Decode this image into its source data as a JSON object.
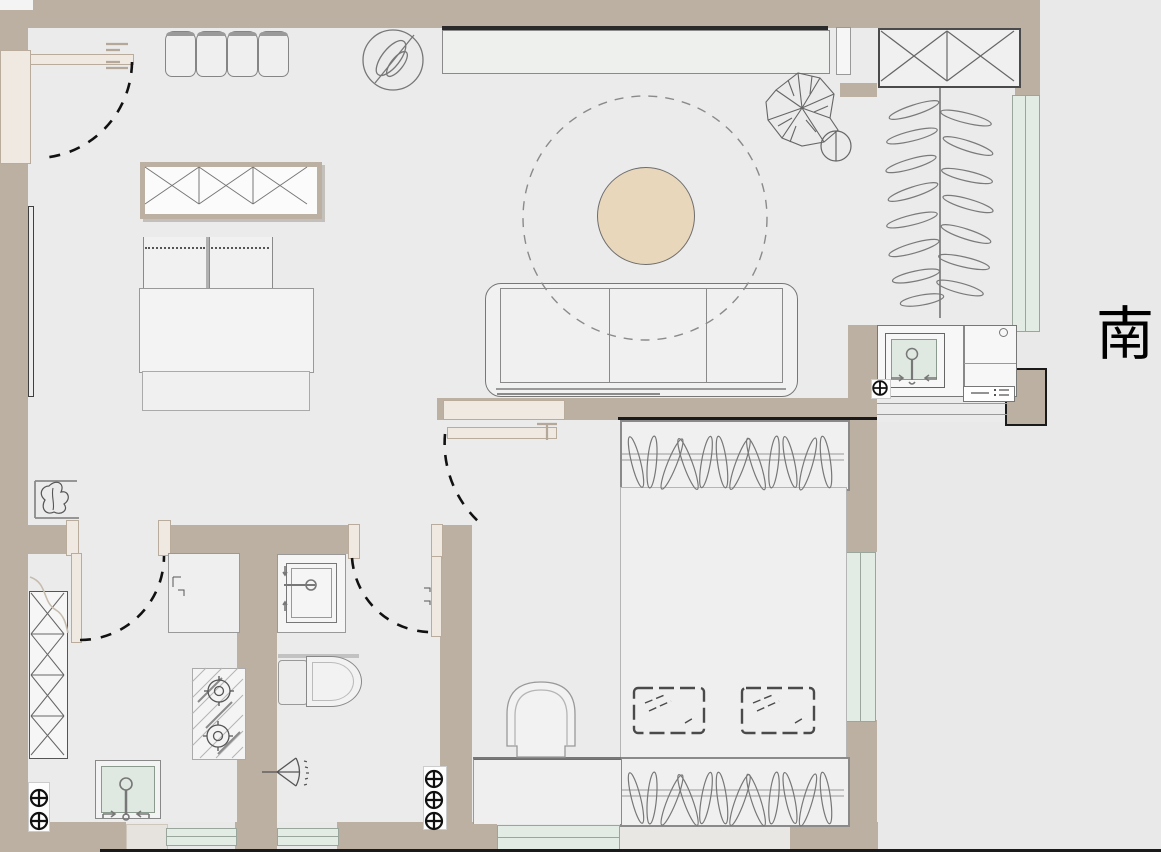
{
  "compass": {
    "label": "南"
  },
  "theme": {
    "bg": "#e9e9e9",
    "floor": "#ebebeb",
    "wall": "#bcb0a3",
    "wall_light": "#efe9e2",
    "frame": "#b9ac9d",
    "window": "#e3ebe5",
    "window_border": "#9aa69c",
    "line": "#8a8a8a",
    "dark": "#1a1a1a",
    "furn": "#f1f1f1",
    "furn_border": "#8a8a8a",
    "table": "#e9d7bc",
    "basin": "#dfe9e1"
  },
  "symbols": [
    "entry-door-swing",
    "kitchen-door-swing",
    "bathroom-door-swing",
    "bedroom-door-swing",
    "sofa",
    "round-coffee-table",
    "round-rug",
    "tv-console",
    "x-frame-console",
    "dining-chairs",
    "desk-with-chairs",
    "potted-plant",
    "tall-plant",
    "leaf-plant",
    "wardrobe-hangers",
    "bed",
    "pillows",
    "stool",
    "bench",
    "toilet",
    "vanity-sink",
    "shower-head",
    "kitchen-sink",
    "gas-stove",
    "x-pantry",
    "kitchenette-counter",
    "kitchenette-sink",
    "floor-drain",
    "window-band",
    "compass-south"
  ]
}
